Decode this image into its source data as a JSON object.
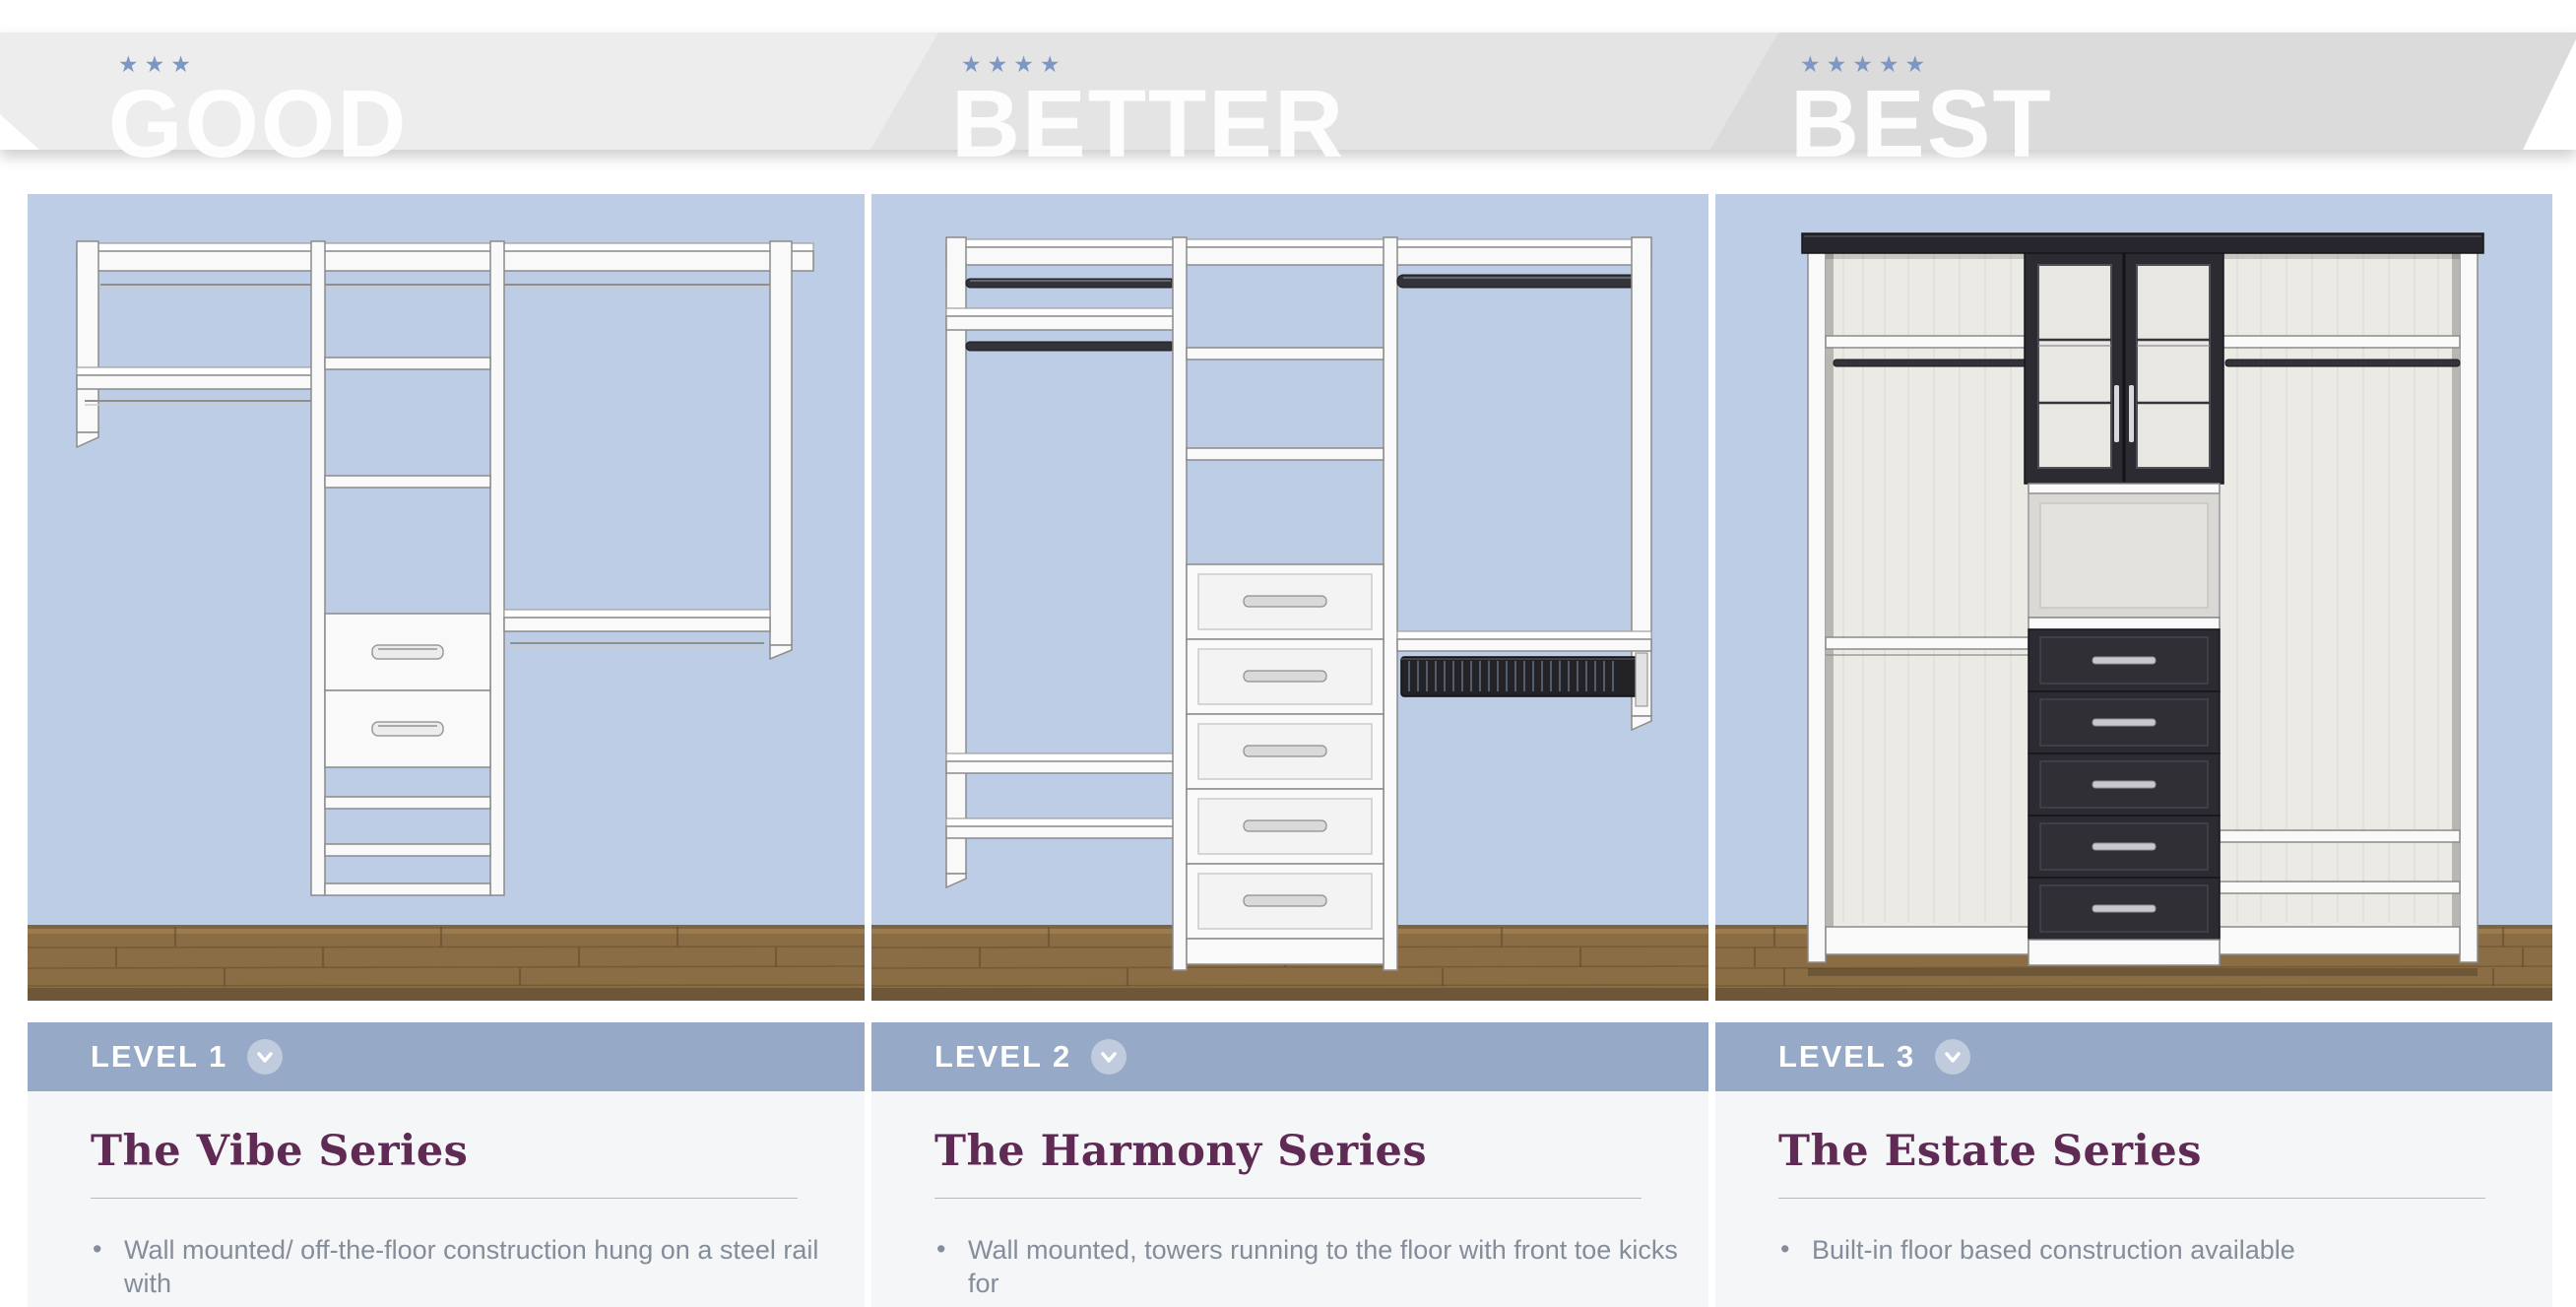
{
  "banner": {
    "star_char": "★",
    "tiers": [
      {
        "label": "GOOD",
        "stars": 3
      },
      {
        "label": "BETTER",
        "stars": 4
      },
      {
        "label": "BEST",
        "stars": 5
      }
    ]
  },
  "columns": [
    {
      "level": "LEVEL 1",
      "series": "The Vibe Series",
      "bullets": [
        "Wall mounted/ off-the-floor construction hung on a steel rail with"
      ]
    },
    {
      "level": "LEVEL 2",
      "series": "The Harmony Series",
      "bullets": [
        "Wall mounted, towers running to the floor with front toe kicks for"
      ]
    },
    {
      "level": "LEVEL 3",
      "series": "The Estate Series",
      "bullets": [
        "Built-in floor based construction available"
      ]
    }
  ],
  "colors": {
    "tier_good_bg": "#ededed",
    "tier_better_bg": "#e4e4e4",
    "tier_best_bg": "#dbdbdb",
    "tier_word": "#ffffff",
    "star": "#7d97c4",
    "level_bar_bg": "#96a9c6",
    "level_text": "#ffffff",
    "card_bg": "#f5f6f7",
    "series_title": "#5f2a54",
    "bullet_text": "#848d9a",
    "wall_blue": "#bccde5",
    "floor_wood": "#8a6d44",
    "closet_white": "#f9f9f9",
    "closet_dark": "#2c2b32"
  }
}
